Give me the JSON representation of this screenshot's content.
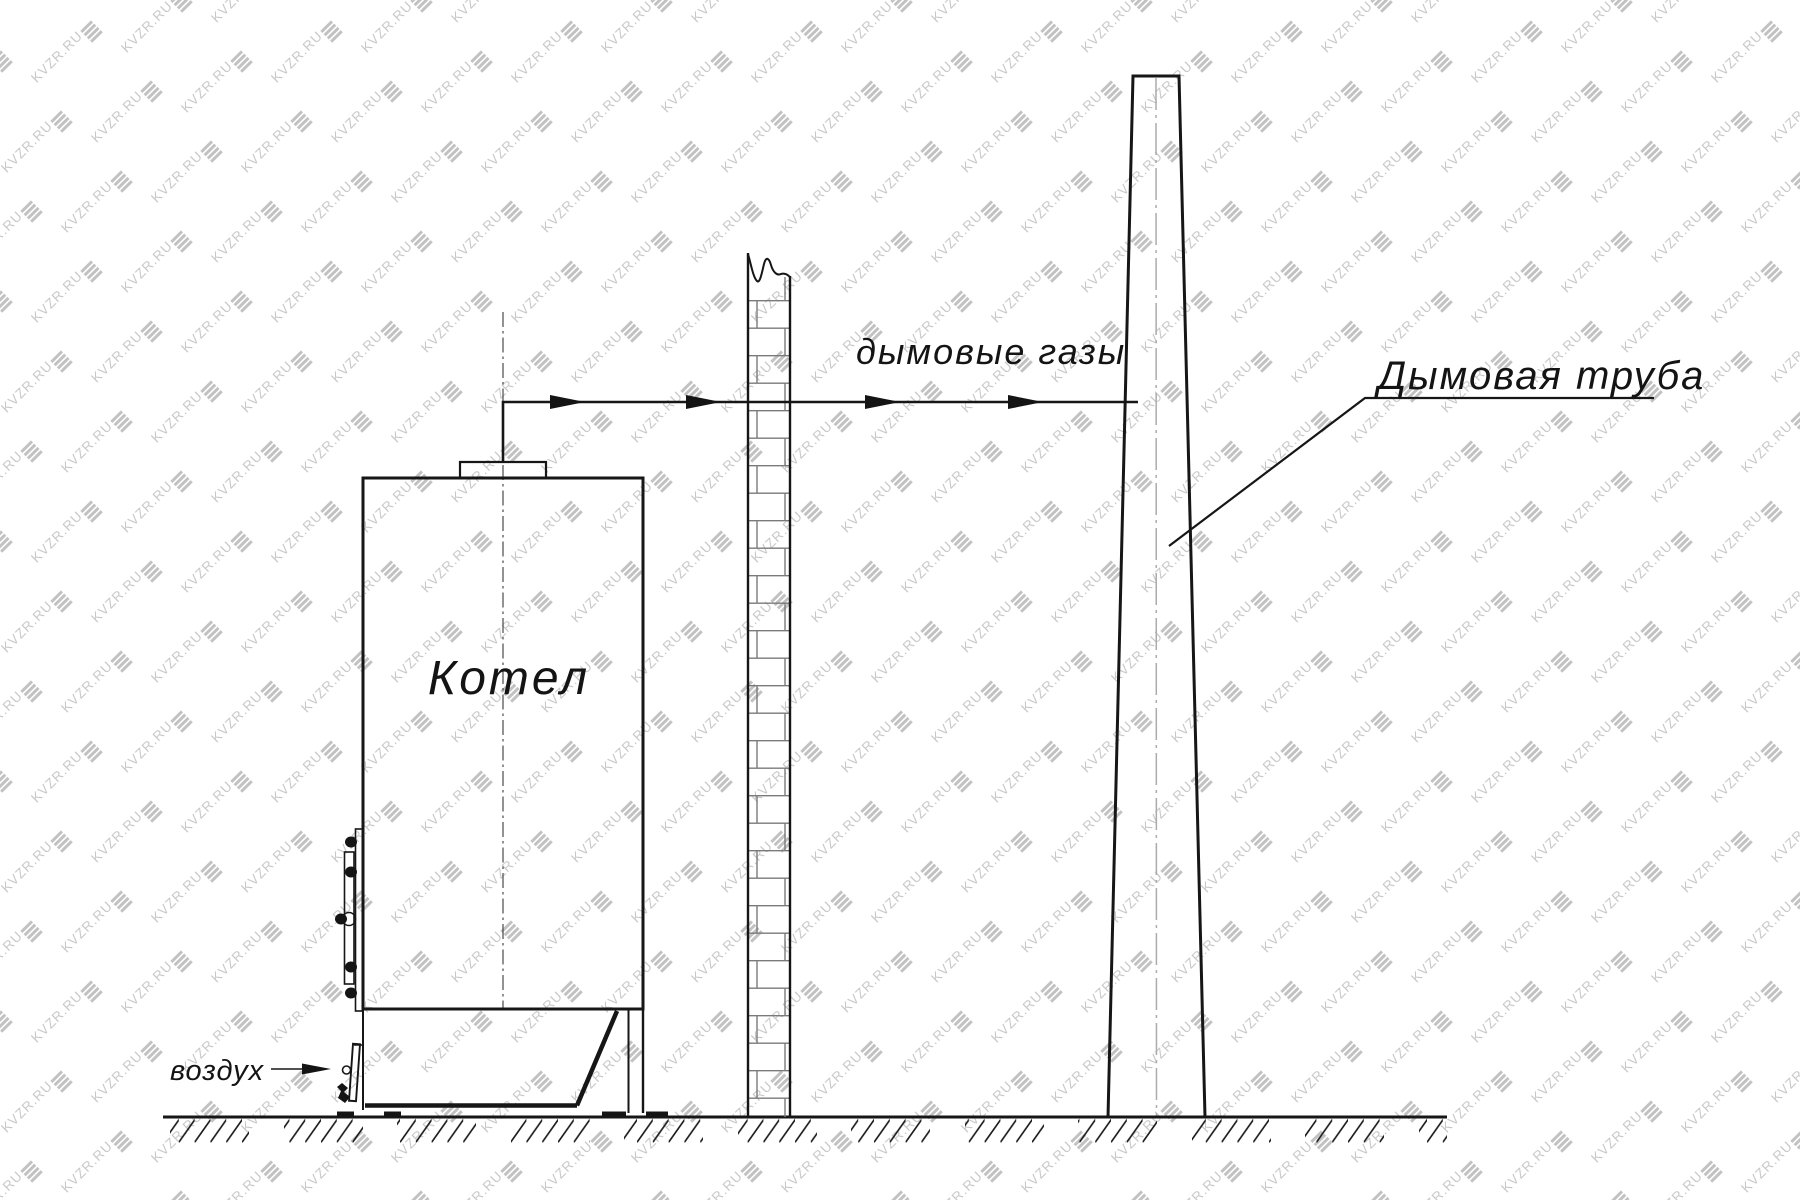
{
  "watermark": {
    "text": "KVZR.RU",
    "logo": "diagonal-stripes-logo",
    "text_color": "#c8c8c8",
    "logo_color": "#c2c2c2"
  },
  "diagram": {
    "labels": {
      "boiler": "Котел",
      "flue_gases": "дымовые газы",
      "chimney": "Дымовая труба",
      "air": "воздух"
    },
    "colors": {
      "background": "#ffffff",
      "main_line": "#161616",
      "brick_joint": "#7a7a7a",
      "boiler_centerline": "#3a3a3a",
      "chimney_centerline": "#ababab"
    }
  }
}
